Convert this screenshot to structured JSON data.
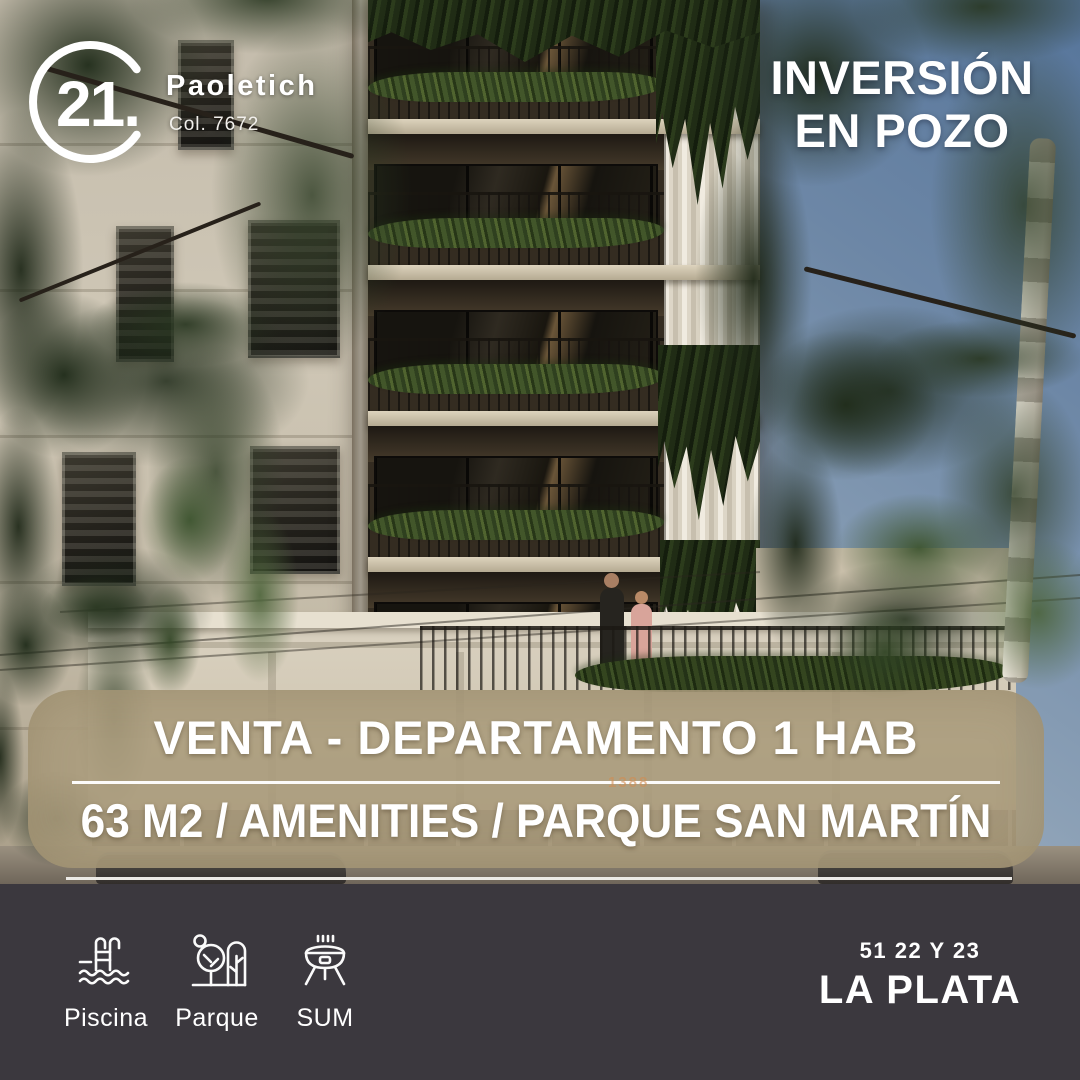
{
  "brand": {
    "logo_text": "21.",
    "agency_name": "Paoletich",
    "license": "Col. 7672"
  },
  "headline": {
    "line1": "INVERSIÓN",
    "line2": "EN POZO"
  },
  "banner": {
    "title": "VENTA - DEPARTAMENTO 1 HAB",
    "subtitle": "63 M2 / AMENITIES / PARQUE SAN MARTÍN"
  },
  "photo": {
    "description": "render of modern apartment tower with planted balconies above classic building, trees and street",
    "building_number": "1388"
  },
  "footer": {
    "amenities": [
      {
        "icon": "pool-icon",
        "label": "Piscina"
      },
      {
        "icon": "park-icon",
        "label": "Parque"
      },
      {
        "icon": "bbq-icon",
        "label": "SUM"
      }
    ],
    "address_line1": "51 22 Y 23",
    "address_line2": "LA PLATA"
  },
  "colors": {
    "footer_bg": "#3b383e",
    "banner_overlay": "#ab9c7d",
    "text": "#ffffff"
  }
}
